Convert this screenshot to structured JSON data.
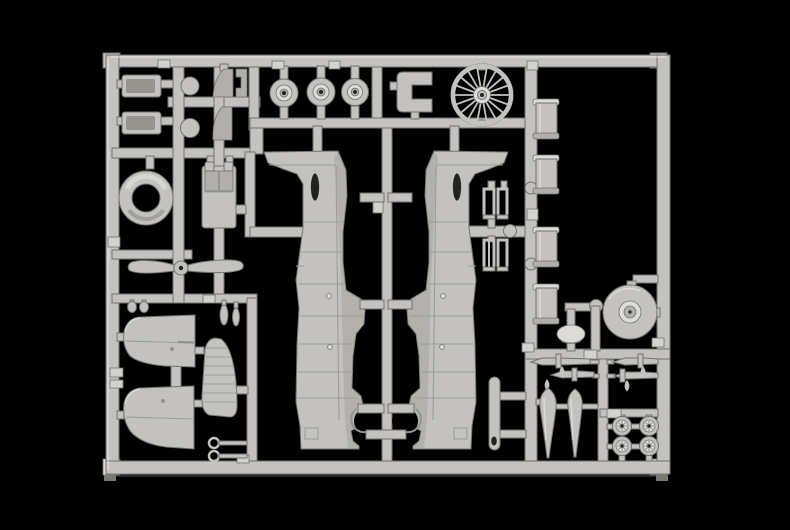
{
  "scene": {
    "description": "Macro photograph of a light grey injection-moulded plastic model kit sprue (parts tree) for a single-engine propeller aircraft, lying on a glossy black background with a faint reflection under the bottom rail",
    "subject": "model-kit-sprue",
    "material": "light grey polystyrene",
    "background_color": "#000000"
  },
  "palette": {
    "bg": "#000000",
    "plastic": "#c3c2be",
    "plastic-light": "#dcdbd7",
    "plastic-mid": "#b0afab",
    "plastic-dark": "#94938d",
    "plastic-edge": "#74736f",
    "tab-light": "#d3d2ce",
    "panel-line": "#9e9d99",
    "highlight": "#eeede9",
    "hole-dark": "#222220",
    "reflection": "#262625",
    "reflection-cap": "#787772"
  },
  "sprue": {
    "frame_shape": "rectangle",
    "parts": [
      {
        "id": "tray-part-1",
        "label": "rectangular tray",
        "section": "top-left"
      },
      {
        "id": "tray-part-2",
        "label": "rectangular tray",
        "section": "top-left"
      },
      {
        "id": "disc-part-1",
        "label": "small disc",
        "section": "top-left"
      },
      {
        "id": "disc-part-2",
        "label": "small disc",
        "section": "top-left"
      },
      {
        "id": "wedge-part-1",
        "label": "curved cowl wedge",
        "section": "top-left"
      },
      {
        "id": "bracket-part",
        "label": "small notched bracket",
        "section": "top-left"
      },
      {
        "id": "wedge-part-2",
        "label": "curved cowl wedge",
        "section": "top-left"
      },
      {
        "id": "main-wheel-part-1",
        "label": "main wheel",
        "section": "top-center"
      },
      {
        "id": "main-wheel-part-2",
        "label": "main wheel",
        "section": "top-center"
      },
      {
        "id": "main-wheel-part-3",
        "label": "main wheel",
        "section": "top-center"
      },
      {
        "id": "open-frame-part",
        "label": "open rectangular frame",
        "section": "top-center"
      },
      {
        "id": "spoked-wheel-part",
        "label": "multi-spoke wheel",
        "section": "top-center"
      },
      {
        "id": "cowling-ring-part",
        "label": "engine cowling ring",
        "section": "left"
      },
      {
        "id": "tank-part",
        "label": "tank with twin top tabs",
        "section": "left"
      },
      {
        "id": "propeller-part",
        "label": "two-blade propeller",
        "section": "left"
      },
      {
        "id": "fuselage-half-left-part",
        "label": "fuselage half",
        "section": "center"
      },
      {
        "id": "fuselage-half-right-part",
        "label": "fuselage half (mirrored)",
        "section": "center"
      },
      {
        "id": "canopy-frame-part-1",
        "label": "small open frame",
        "section": "center-right"
      },
      {
        "id": "canopy-frame-part-2",
        "label": "small open frame",
        "section": "center-right"
      },
      {
        "id": "canopy-frame-part-3",
        "label": "small open frame",
        "section": "center-right"
      },
      {
        "id": "canopy-frame-part-4",
        "label": "small open frame",
        "section": "center-right"
      },
      {
        "id": "cylinder-part-1",
        "label": "cylindrical tank",
        "section": "right-column"
      },
      {
        "id": "cylinder-part-2",
        "label": "cylindrical tank",
        "section": "right-column"
      },
      {
        "id": "cylinder-part-3",
        "label": "cylindrical tank",
        "section": "right-column"
      },
      {
        "id": "cylinder-part-4",
        "label": "cylindrical tank",
        "section": "right-column"
      },
      {
        "id": "hub-disc-part",
        "label": "large disc with raised hub",
        "section": "right-column"
      },
      {
        "id": "dome-part",
        "label": "dome cap",
        "section": "right-column"
      },
      {
        "id": "exhaust-pipe-part",
        "label": "exhaust pipe with open end",
        "section": "bottom-center"
      },
      {
        "id": "gun-part-1",
        "label": "machine gun",
        "section": "bottom-right"
      },
      {
        "id": "gun-part-2",
        "label": "machine gun",
        "section": "bottom-right"
      },
      {
        "id": "gun-part-3",
        "label": "machine gun",
        "section": "bottom-right"
      },
      {
        "id": "gun-part-4",
        "label": "machine gun",
        "section": "bottom-right"
      },
      {
        "id": "drop-tank-part-1",
        "label": "teardrop drop tank",
        "section": "bottom-right"
      },
      {
        "id": "drop-tank-part-2",
        "label": "teardrop drop tank",
        "section": "bottom-right"
      },
      {
        "id": "small-wheel-part-1",
        "label": "small ribbed wheel",
        "section": "bottom-right"
      },
      {
        "id": "small-wheel-part-2",
        "label": "small ribbed wheel",
        "section": "bottom-right"
      },
      {
        "id": "small-wheel-part-3",
        "label": "small ribbed wheel",
        "section": "bottom-right"
      },
      {
        "id": "small-wheel-part-4",
        "label": "small ribbed wheel",
        "section": "bottom-right"
      },
      {
        "id": "wing-panel-part-1",
        "label": "wing panel",
        "section": "bottom-left"
      },
      {
        "id": "wing-panel-part-2",
        "label": "wing panel",
        "section": "bottom-left"
      },
      {
        "id": "rudder-part",
        "label": "ribbed rudder",
        "section": "bottom-left"
      },
      {
        "id": "tow-ring-part-1",
        "label": "ring-ended rod",
        "section": "bottom-left"
      },
      {
        "id": "tow-ring-part-2",
        "label": "ring-ended rod",
        "section": "bottom-left"
      },
      {
        "id": "scoop-part-1",
        "label": "small intake scoop",
        "section": "bottom-left"
      },
      {
        "id": "scoop-part-2",
        "label": "small intake scoop",
        "section": "bottom-left"
      },
      {
        "id": "scoop-part-3",
        "label": "small intake scoop",
        "section": "bottom-left"
      },
      {
        "id": "scoop-part-4",
        "label": "small intake scoop",
        "section": "bottom-left"
      }
    ]
  }
}
